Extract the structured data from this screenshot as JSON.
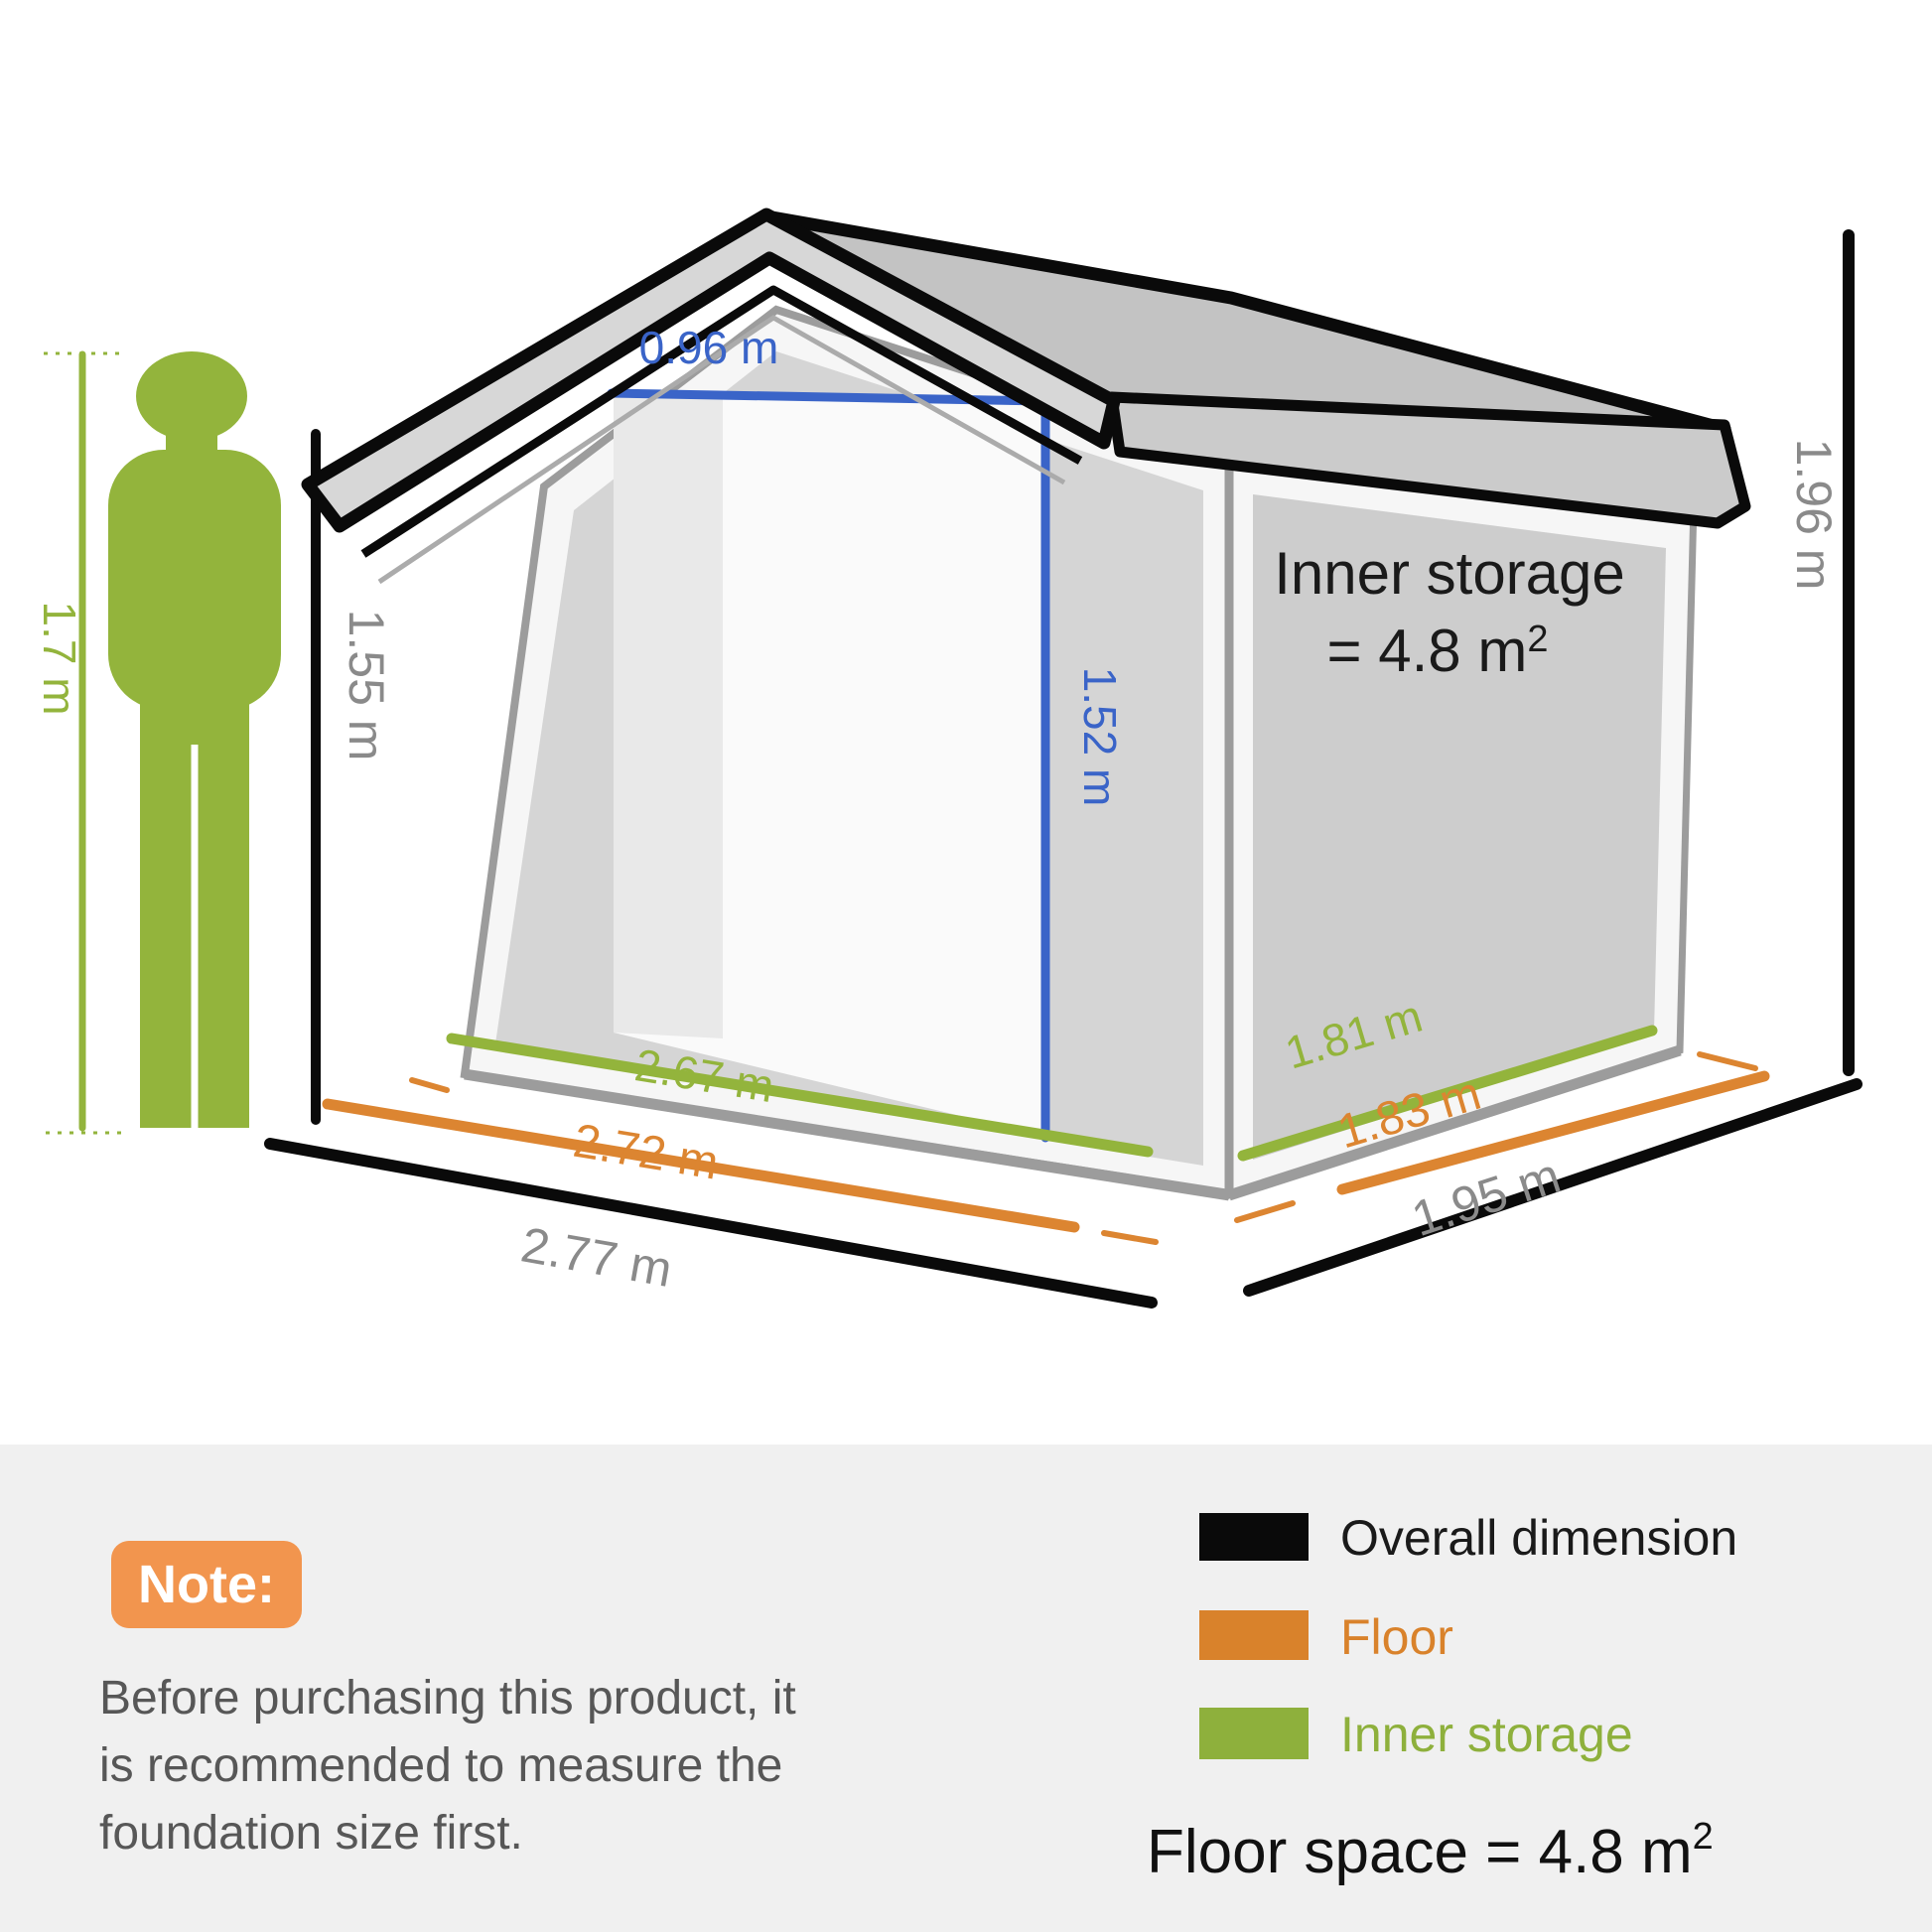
{
  "scene": {
    "person": {
      "height_label": "1.7 m"
    },
    "dimensions": {
      "door_width": "0.96 m",
      "door_height": "1.52 m",
      "wall_height": "1.55 m",
      "overall_height": "1.96 m",
      "inner_width": "2.67 m",
      "floor_width": "2.72 m",
      "overall_width": "2.77 m",
      "inner_depth": "1.81 m",
      "floor_depth": "1.83 m",
      "overall_depth": "1.95 m"
    },
    "inner_storage": {
      "line1": "Inner storage",
      "line2_base": "= 4.8 m",
      "line2_sup": "2"
    }
  },
  "note": {
    "badge": "Note:",
    "lines": [
      "Before purchasing this product, it",
      "is recommended to measure the",
      "foundation size first."
    ]
  },
  "legend": {
    "items": [
      {
        "label": "Overall dimension",
        "color": "#0A0A0A"
      },
      {
        "label": "Floor",
        "color": "#D9822B"
      },
      {
        "label": "Inner storage",
        "color": "#8EB03C"
      }
    ],
    "floor_space_base": "Floor space = 4.8 m",
    "floor_space_sup": "2"
  },
  "colors": {
    "black": "#0A0A0A",
    "green": "#93B43C",
    "legend_green": "#8EB03C",
    "orange": "#DC8531",
    "legend_orange": "#D9822B",
    "badge_orange": "#F2954E",
    "blue": "#3A64C8",
    "gray_label": "#8A8A8A",
    "panel_bg": "#F0F0F0"
  }
}
